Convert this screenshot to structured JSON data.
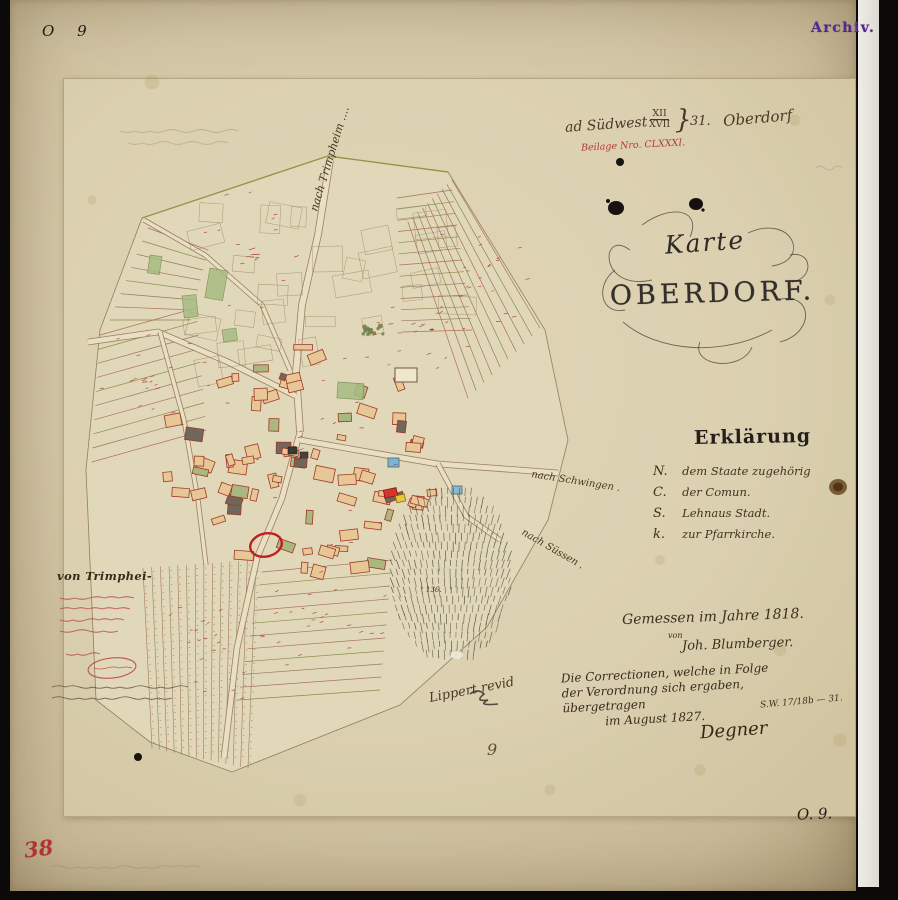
{
  "colors": {
    "red_ink": "#b13a34",
    "brown_ink": "#4a3726",
    "purple_stamp": "#55288f",
    "olive_boundary": "#7d7d35",
    "rose_boundary": "#a5604e"
  },
  "archive_marks": {
    "corner_top_left": "O 9",
    "archiv_stamp": "Archiv.",
    "corner_bottom_right": "O. 9.",
    "corner_bottom_left_red": "38",
    "bottom_center_number": "9"
  },
  "header": {
    "prefix": "ad Südwest",
    "fraction_top": "XII",
    "fraction_bottom": "XVII",
    "brace": "}",
    "number": "31.",
    "place": "Oberdorf",
    "attachment_red": "Beilage Nro. CLXXXI."
  },
  "title": {
    "line1": "Karte",
    "line2": "OBERDORF."
  },
  "legend": {
    "heading": "Erklärung",
    "items": [
      {
        "symbol": "N.",
        "label": "dem Staate zugehörig"
      },
      {
        "symbol": "C.",
        "label": "der Comun."
      },
      {
        "symbol": "S.",
        "label": "Lehnaus Stadt."
      },
      {
        "symbol": "k.",
        "label": "zur Pfarrkirche."
      }
    ]
  },
  "survey": {
    "line1": "Gemessen im Jahre 1818.",
    "von": "von",
    "surveyor": "Joh. Blumberger."
  },
  "revision": {
    "line1": "Die Correctionen, welche in Folge",
    "line2": "der Verordnung sich ergaben,",
    "line3": "übergetragen",
    "line4": "im August 1827.",
    "signature": "Degner",
    "ref": "S.W. 17/18b — 31."
  },
  "map_labels": {
    "road_north": "nach Trimpheim ....",
    "road_east_upper": "nach Schwingen .",
    "road_east_lower": "nach Süssen .",
    "margin_heading": "von Trimphei-",
    "revision_note": "Lippert      revid",
    "parcel_number": "136."
  }
}
